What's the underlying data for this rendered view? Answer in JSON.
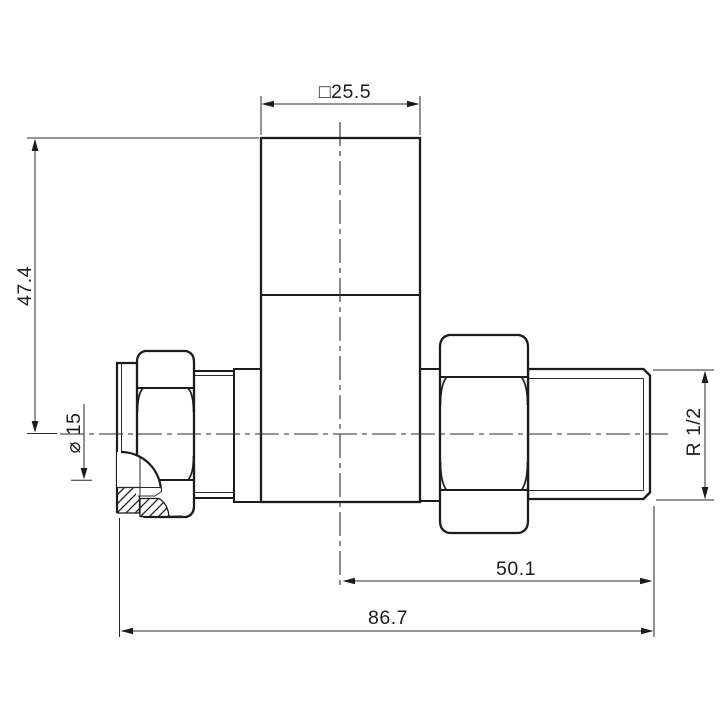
{
  "drawing": {
    "kind": "radiator-valve technical drawing",
    "colors": {
      "line": "#1c1c1c",
      "background": "#ffffff"
    },
    "dims": {
      "square": "□25.5",
      "height": "47.4",
      "bore": "⌀ 15",
      "thread": "R 1/2",
      "center_to_end": "50.1",
      "overall": "86.7"
    }
  }
}
